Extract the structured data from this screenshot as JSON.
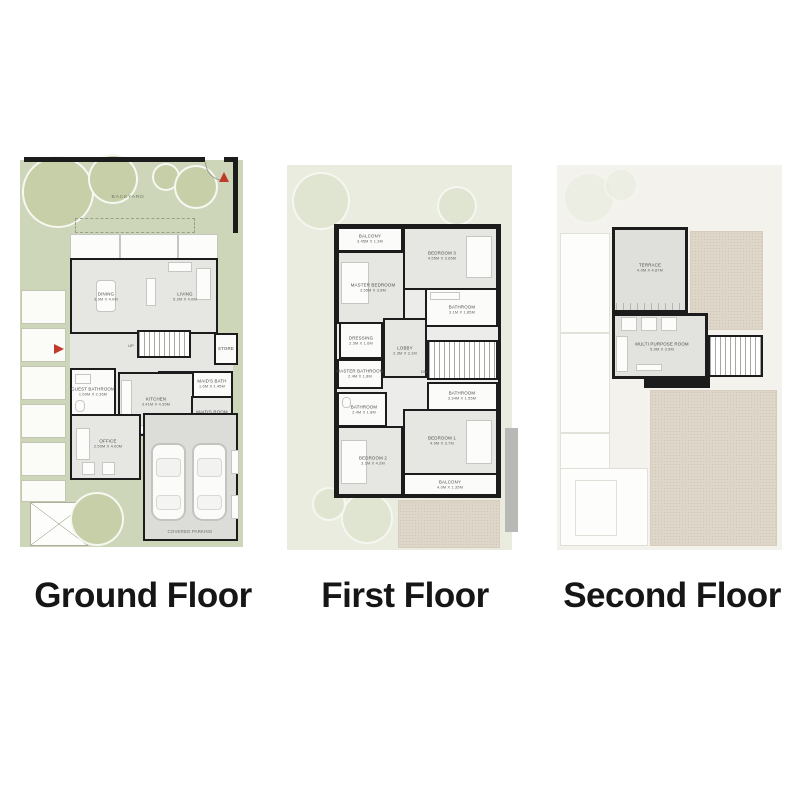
{
  "captions": {
    "ground": "Ground Floor",
    "first": "First Floor",
    "second": "Second Floor"
  },
  "ground": {
    "backyard": "BACKYARD",
    "sideyard": "SIDEYARD",
    "store": "STORE",
    "laundry": "LAUNDRY",
    "up": "UP",
    "parking": "COVERED PARKING",
    "rooms": {
      "dining": {
        "name": "DINING",
        "dims": "3.0M X 4.0M"
      },
      "living": {
        "name": "LIVING",
        "dims": "5.2M X 4.0M"
      },
      "guest_bathroom": {
        "name": "GUEST BATHROOM",
        "dims": "1.60M X 2.35M"
      },
      "maids_bath": {
        "name": "MAID'S BATH",
        "dims": "1.6M X 1.45M"
      },
      "kitchen": {
        "name": "KITCHEN",
        "dims": "3.41M X 4.35M"
      },
      "maids_room": {
        "name": "MAID'S ROOM",
        "dims": "1.8M X 2.1M"
      },
      "office": {
        "name": "OFFICE",
        "dims": "2.50M X 4.00M"
      }
    }
  },
  "first": {
    "dn": "DN",
    "rooms": {
      "balcony_top": {
        "name": "BALCONY",
        "dims": "3.45M X 1.3M"
      },
      "bedroom3": {
        "name": "BEDROOM 3",
        "dims": "4.55M X 3.65M"
      },
      "master_bedroom": {
        "name": "MASTER BEDROOM",
        "dims": "3.55M X 3.8M"
      },
      "bathroom_top": {
        "name": "BATHROOM",
        "dims": "3.1M X 1.85M"
      },
      "dressing": {
        "name": "DRESSING",
        "dims": "2.3M X 1.6M"
      },
      "lobby": {
        "name": "LOBBY",
        "dims": "2.3M X 3.1M"
      },
      "master_bathroom": {
        "name": "MASTER BATHROOM",
        "dims": "2.4M X 1.8M"
      },
      "bathroom_left": {
        "name": "BATHROOM",
        "dims": "2.4M X 1.8M"
      },
      "bathroom_right": {
        "name": "BATHROOM",
        "dims": "3.34M X 1.55M"
      },
      "bedroom1": {
        "name": "BEDROOM 1",
        "dims": "4.0M X 3.7M"
      },
      "bedroom2": {
        "name": "BEDROOM 2",
        "dims": "3.1M X 4.2M"
      },
      "balcony_bottom": {
        "name": "BALCONY",
        "dims": "4.0M X 1.35M"
      }
    }
  },
  "second": {
    "rooms": {
      "terrace": {
        "name": "TERRACE",
        "dims": "4.0M X 4.87M"
      },
      "multi_purpose": {
        "name": "MULTI PURPOSE ROOM",
        "dims": "5.0M X 3.5M"
      }
    }
  },
  "icons": {
    "entry_arrow": "red-triangle-marker",
    "trees": "landscape-tree-circles"
  },
  "colors": {
    "yard_green": "#cdd6b9",
    "tree_green": "#c6cfa8",
    "wall_black": "#1c1c1c",
    "floor_gray": "#e6e6e3",
    "beige_texture": "#ded6c8",
    "accent_red": "#c0392b"
  }
}
